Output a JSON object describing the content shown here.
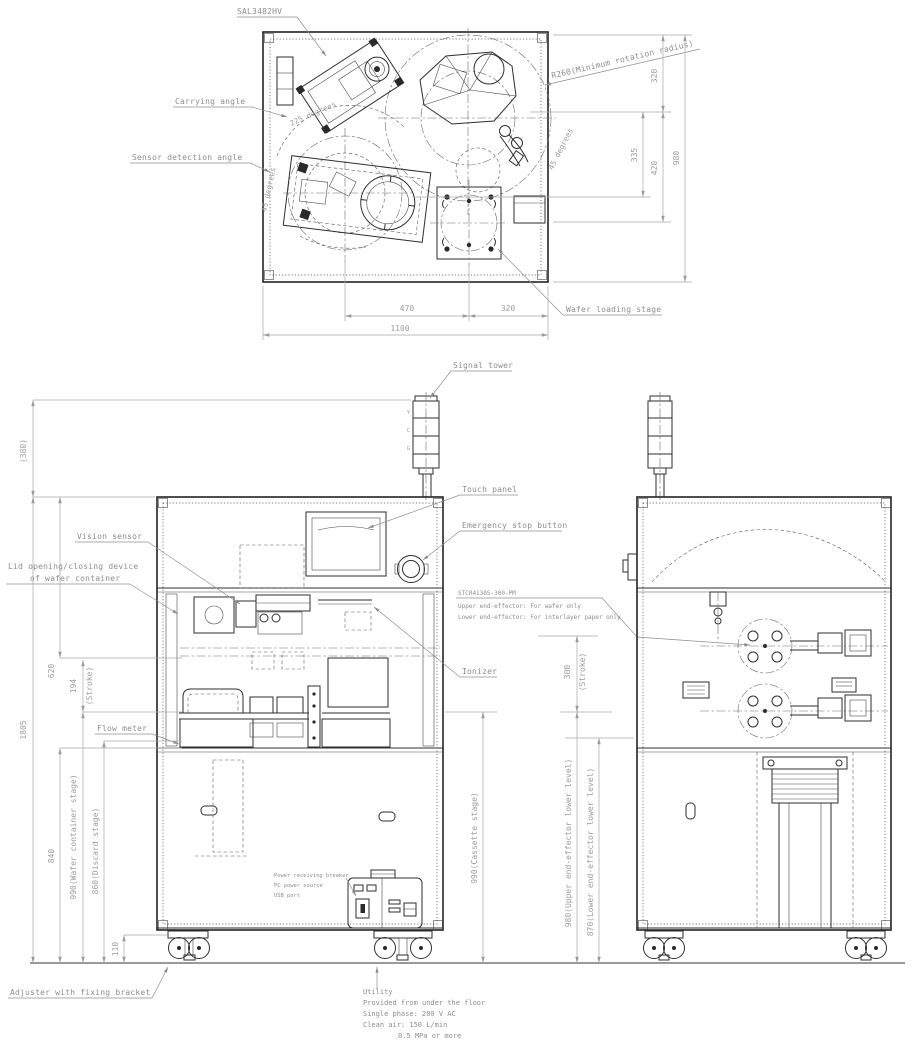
{
  "drawing": {
    "top_view": {
      "robot_model": "SAL3482HV",
      "min_rotation_radius": "R260(Minimum rotation radius)",
      "carrying_angle_label": "Carrying angle",
      "carrying_angle_value": "225 degrees",
      "sensor_detection_label": "Sensor detection angle",
      "sensor_detection_value": "45 degrees",
      "swing_angle_value": "45 degrees",
      "wafer_loading_stage_label": "Wafer loading stage",
      "dim_470": "470",
      "dim_320_bottom": "320",
      "dim_1100": "1100",
      "dim_320_right": "320",
      "dim_335": "335",
      "dim_420": "420",
      "dim_980": "980"
    },
    "front_view": {
      "signal_tower_label": "Signal tower",
      "tower_letter_top": "Y",
      "tower_letter_mid": "C",
      "tower_letter_bottom": "G",
      "touch_panel_label": "Touch panel",
      "emergency_stop_label": "Emergency stop button",
      "vision_sensor_label": "Vision sensor",
      "lid_device_line1": "Lid opening/closing device",
      "lid_device_line2": "of wafer container",
      "ionizer_label": "Ionizer",
      "flow_meter_label": "Flow meter",
      "power_note_line1": "Power receiving breaker",
      "power_note_line2": "PC power source",
      "power_note_line3": "USB port",
      "adjuster_label": "Adjuster with fixing bracket"
    },
    "end_effector_note": {
      "model": "STCR4130S-300-PM",
      "upper": "Upper end-effector: For wafer only",
      "lower": "Lower end-effector: For interlayer paper only"
    },
    "utility_note": {
      "title": "Utility",
      "line1": "Provided from under the floor",
      "line2": "Single phase: 200 V AC",
      "line3": "Clean air: 150 L/min",
      "line4": "0.5 MPa or more"
    },
    "elevation_dims": {
      "signal_tower_height": "(380)",
      "machine_height": "1805",
      "dim_620": "620",
      "dim_194": "194",
      "stroke_front": "(Stroke)",
      "dim_840": "840",
      "wafer_container_stage": "990(Wafer container stage)",
      "discard_stage": "860(Discard stage)",
      "base_height": "110",
      "cassette_stage": "990(Cassette stage)",
      "dim_300": "300",
      "stroke_side": "(Stroke)",
      "upper_effector_level": "980(Upper end-effector lower level)",
      "lower_effector_level": "870(Lower end-effector lower level)"
    }
  }
}
